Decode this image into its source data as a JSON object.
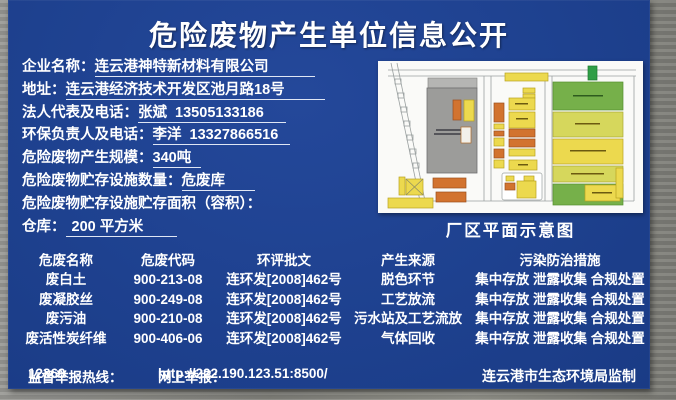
{
  "title": "危险废物产生单位信息公开",
  "info_fields": {
    "enterprise": {
      "label": "企业名称：",
      "value": "连云港神特新材料有限公司"
    },
    "address": {
      "label": "地址：",
      "value": "连云港经济技术开发区池月路18号"
    },
    "legal_rep": {
      "label": "法人代表及电话：",
      "value": "张斌  13505133186"
    },
    "env_manager": {
      "label": "环保负责人及电话：",
      "value": "李洋  13327866516"
    },
    "scale": {
      "label": "危险废物产生规模：",
      "value": "340吨"
    },
    "storage_num": {
      "label": "危险废物贮存设施数量：",
      "value": "危废库"
    },
    "storage_area_label": {
      "label": "危险废物贮存设施贮存面积（容积）：",
      "value": ""
    },
    "warehouse": {
      "label": "仓库：",
      "value": "200 平方米"
    }
  },
  "map": {
    "caption": "厂区平面示意图"
  },
  "waste_table": {
    "headers": [
      "危废名称",
      "危废代码",
      "环评批文",
      "产生来源",
      "污染防治措施"
    ],
    "rows": [
      [
        "废白土",
        "900-213-08",
        "连环发[2008]462号",
        "脱色环节",
        "集中存放 泄露收集 合规处置"
      ],
      [
        "废凝胶丝",
        "900-249-08",
        "连环发[2008]462号",
        "工艺放流",
        "集中存放 泄露收集 合规处置"
      ],
      [
        "废污油",
        "900-210-08",
        "连环发[2008]462号",
        "污水站及工艺流放",
        "集中存放 泄露收集 合规处置"
      ],
      [
        "废活性炭纤维",
        "900-406-06",
        "连环发[2008]462号",
        "气体回收",
        "集中存放 泄露收集 合规处置"
      ]
    ]
  },
  "footer": {
    "hotline_label": "监督举报热线： ",
    "hotline_value": "12369",
    "online_label": "网上举报：",
    "online_value": "http://222.190.123.51:8500/",
    "authority": "连云港市生态环境局监制"
  },
  "colors": {
    "board_blue": "#1e418f",
    "frame_gray": "#8f8f8b",
    "text_white": "#ffffff",
    "map_yellow": "#ecd94e",
    "map_orange": "#d2732f",
    "map_green": "#76b04a",
    "map_yellowgreen": "#d6d75c",
    "map_building_gray": "#9c9c9a"
  }
}
